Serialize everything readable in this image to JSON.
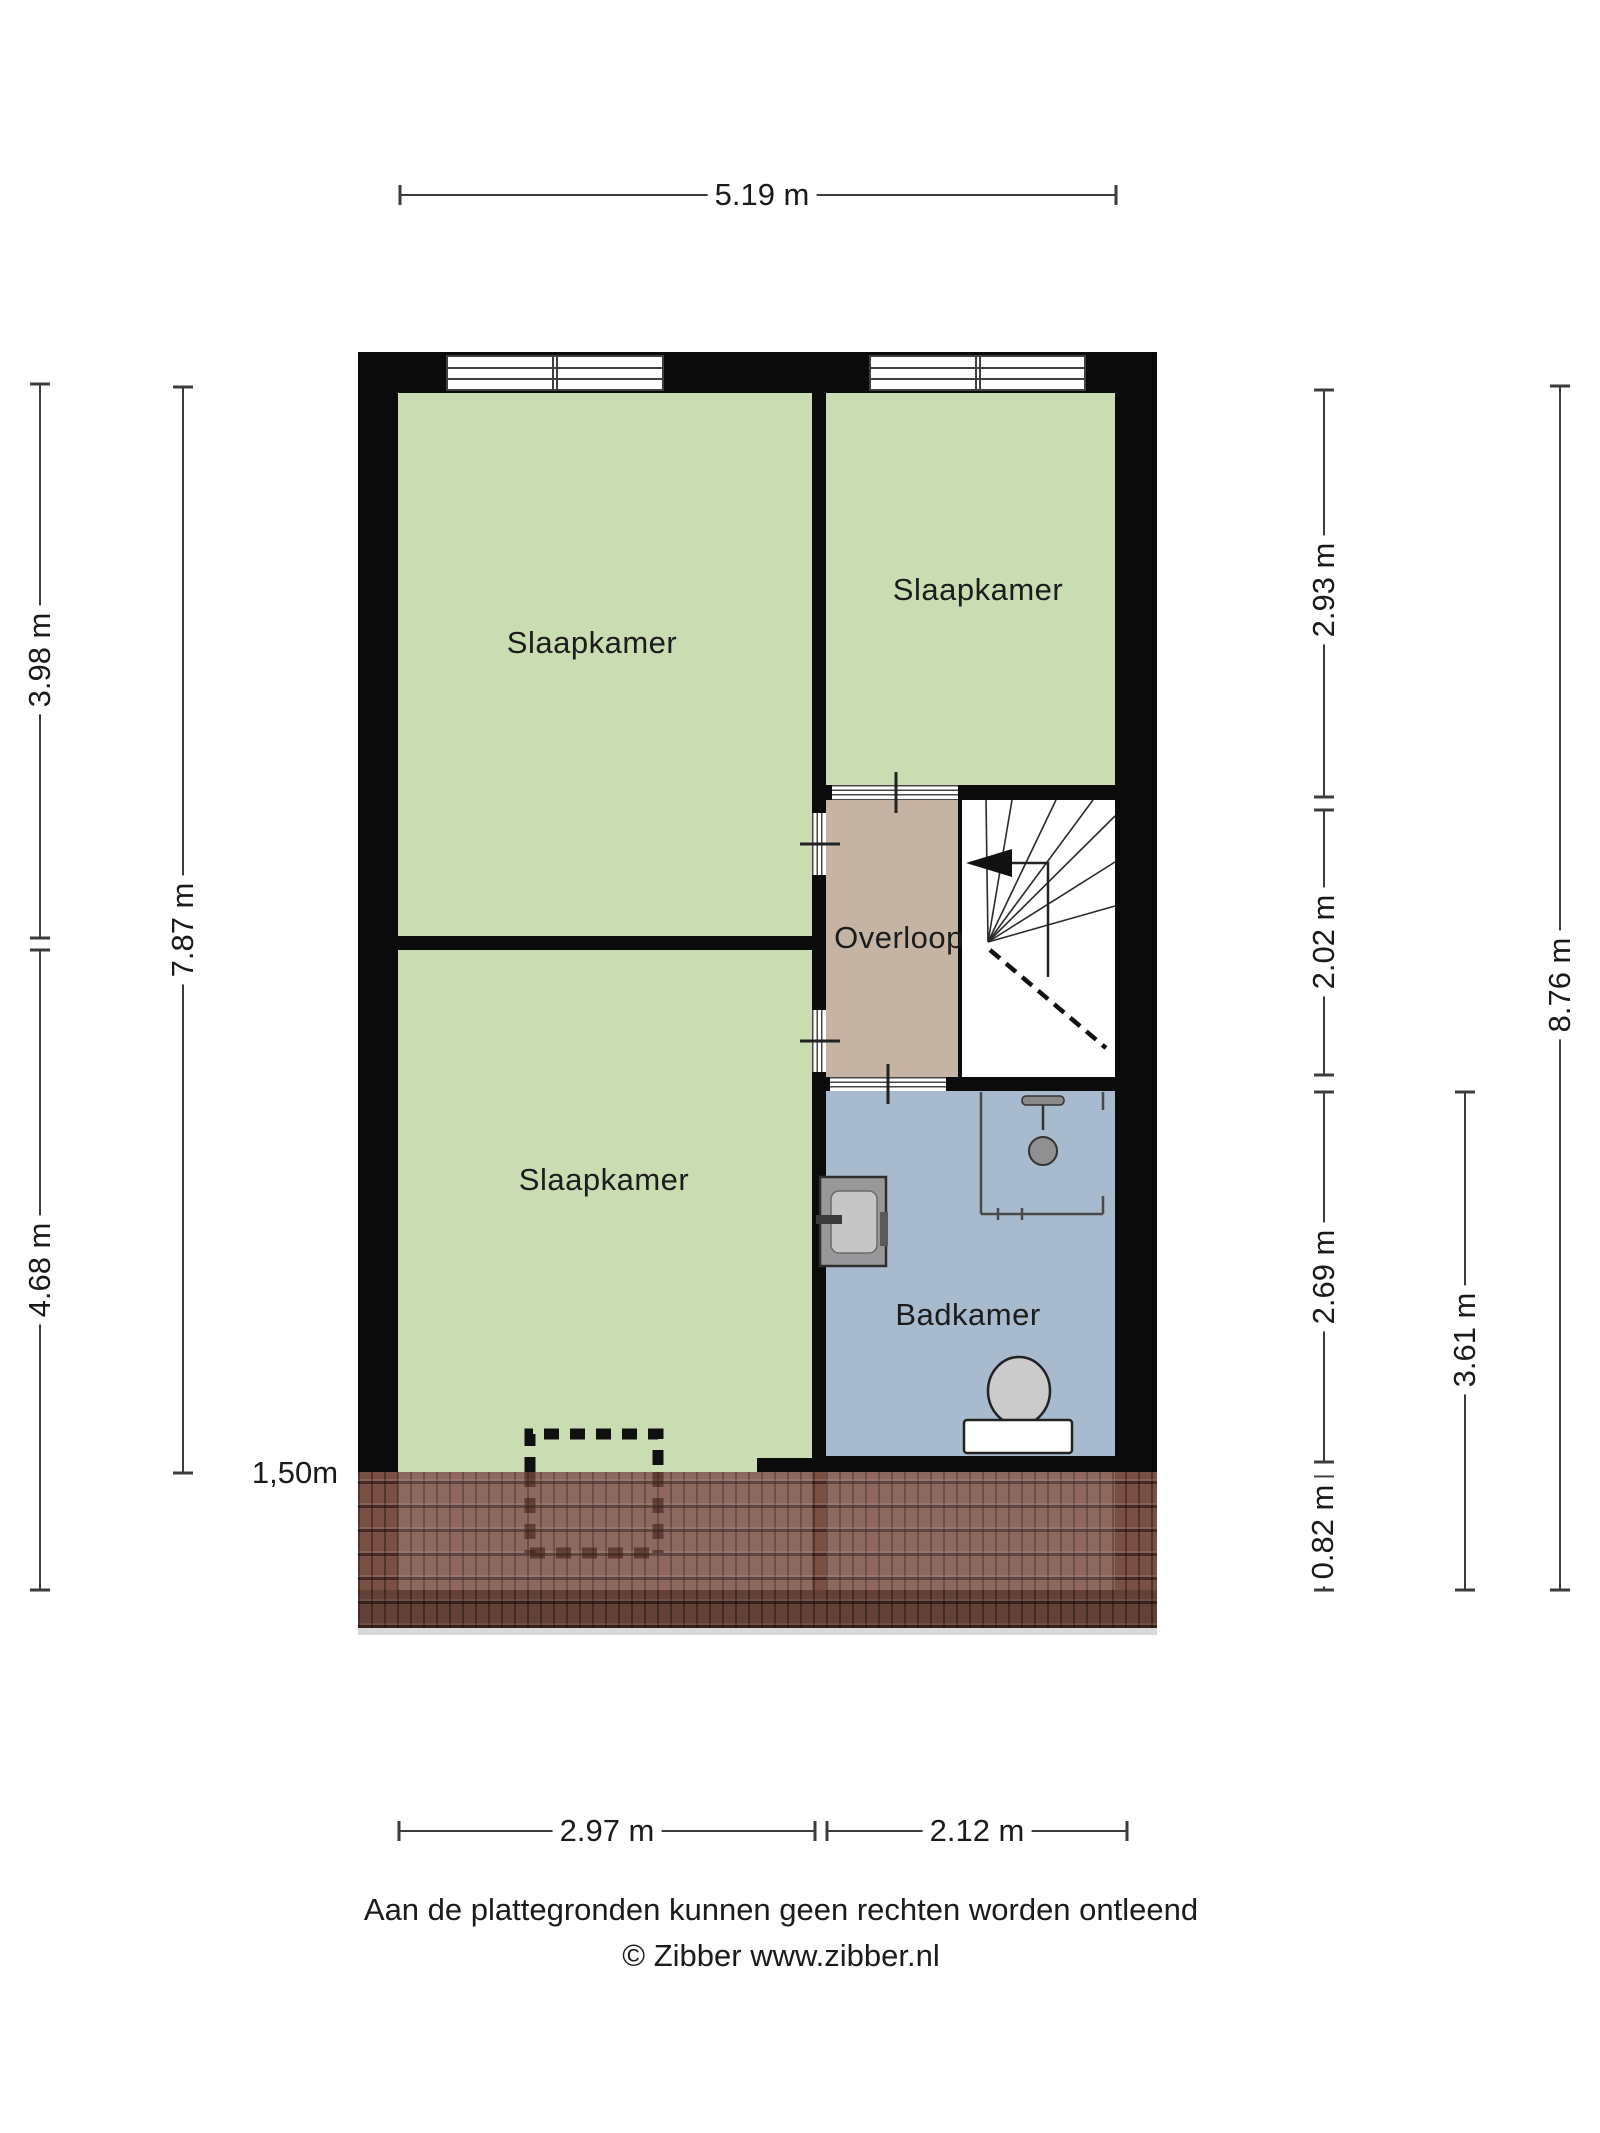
{
  "title": "Floor plan - verdieping (Zibber plattegrond)",
  "rooms": {
    "bedroom_tl": "Slaapkamer",
    "bedroom_tr": "Slaapkamer",
    "bedroom_bl": "Slaapkamer",
    "landing": "Overloop",
    "bathroom": "Badkamer"
  },
  "dimensions": {
    "top_width": "5.19 m",
    "bottom_left_width": "2.97 m",
    "bottom_right_width": "2.12 m",
    "left_upper": "3.98 m",
    "left_lower": "4.68 m",
    "left_inner_total": "7.87 m",
    "right_bedroom": "2.93 m",
    "right_landing": "2.02 m",
    "right_bathroom": "2.69 m",
    "right_knee": "0.82 m",
    "right_inner_total": "3.61 m",
    "right_outer_total": "8.76 m",
    "knee_wall_height": "1,50m"
  },
  "footer": {
    "line1": "Aan de plattegronden kunnen geen rechten worden ontleend",
    "line2": "© Zibber www.zibber.nl"
  },
  "colors": {
    "room-green": "#c9dcb2",
    "landing-tan": "#c5b4a3",
    "bath-blue": "#a8bacd",
    "wall-black": "#0b0b0b",
    "roof-base": "#7b5044",
    "dim-line": "#3c3c3c",
    "shadow": "#d9d9d9"
  }
}
